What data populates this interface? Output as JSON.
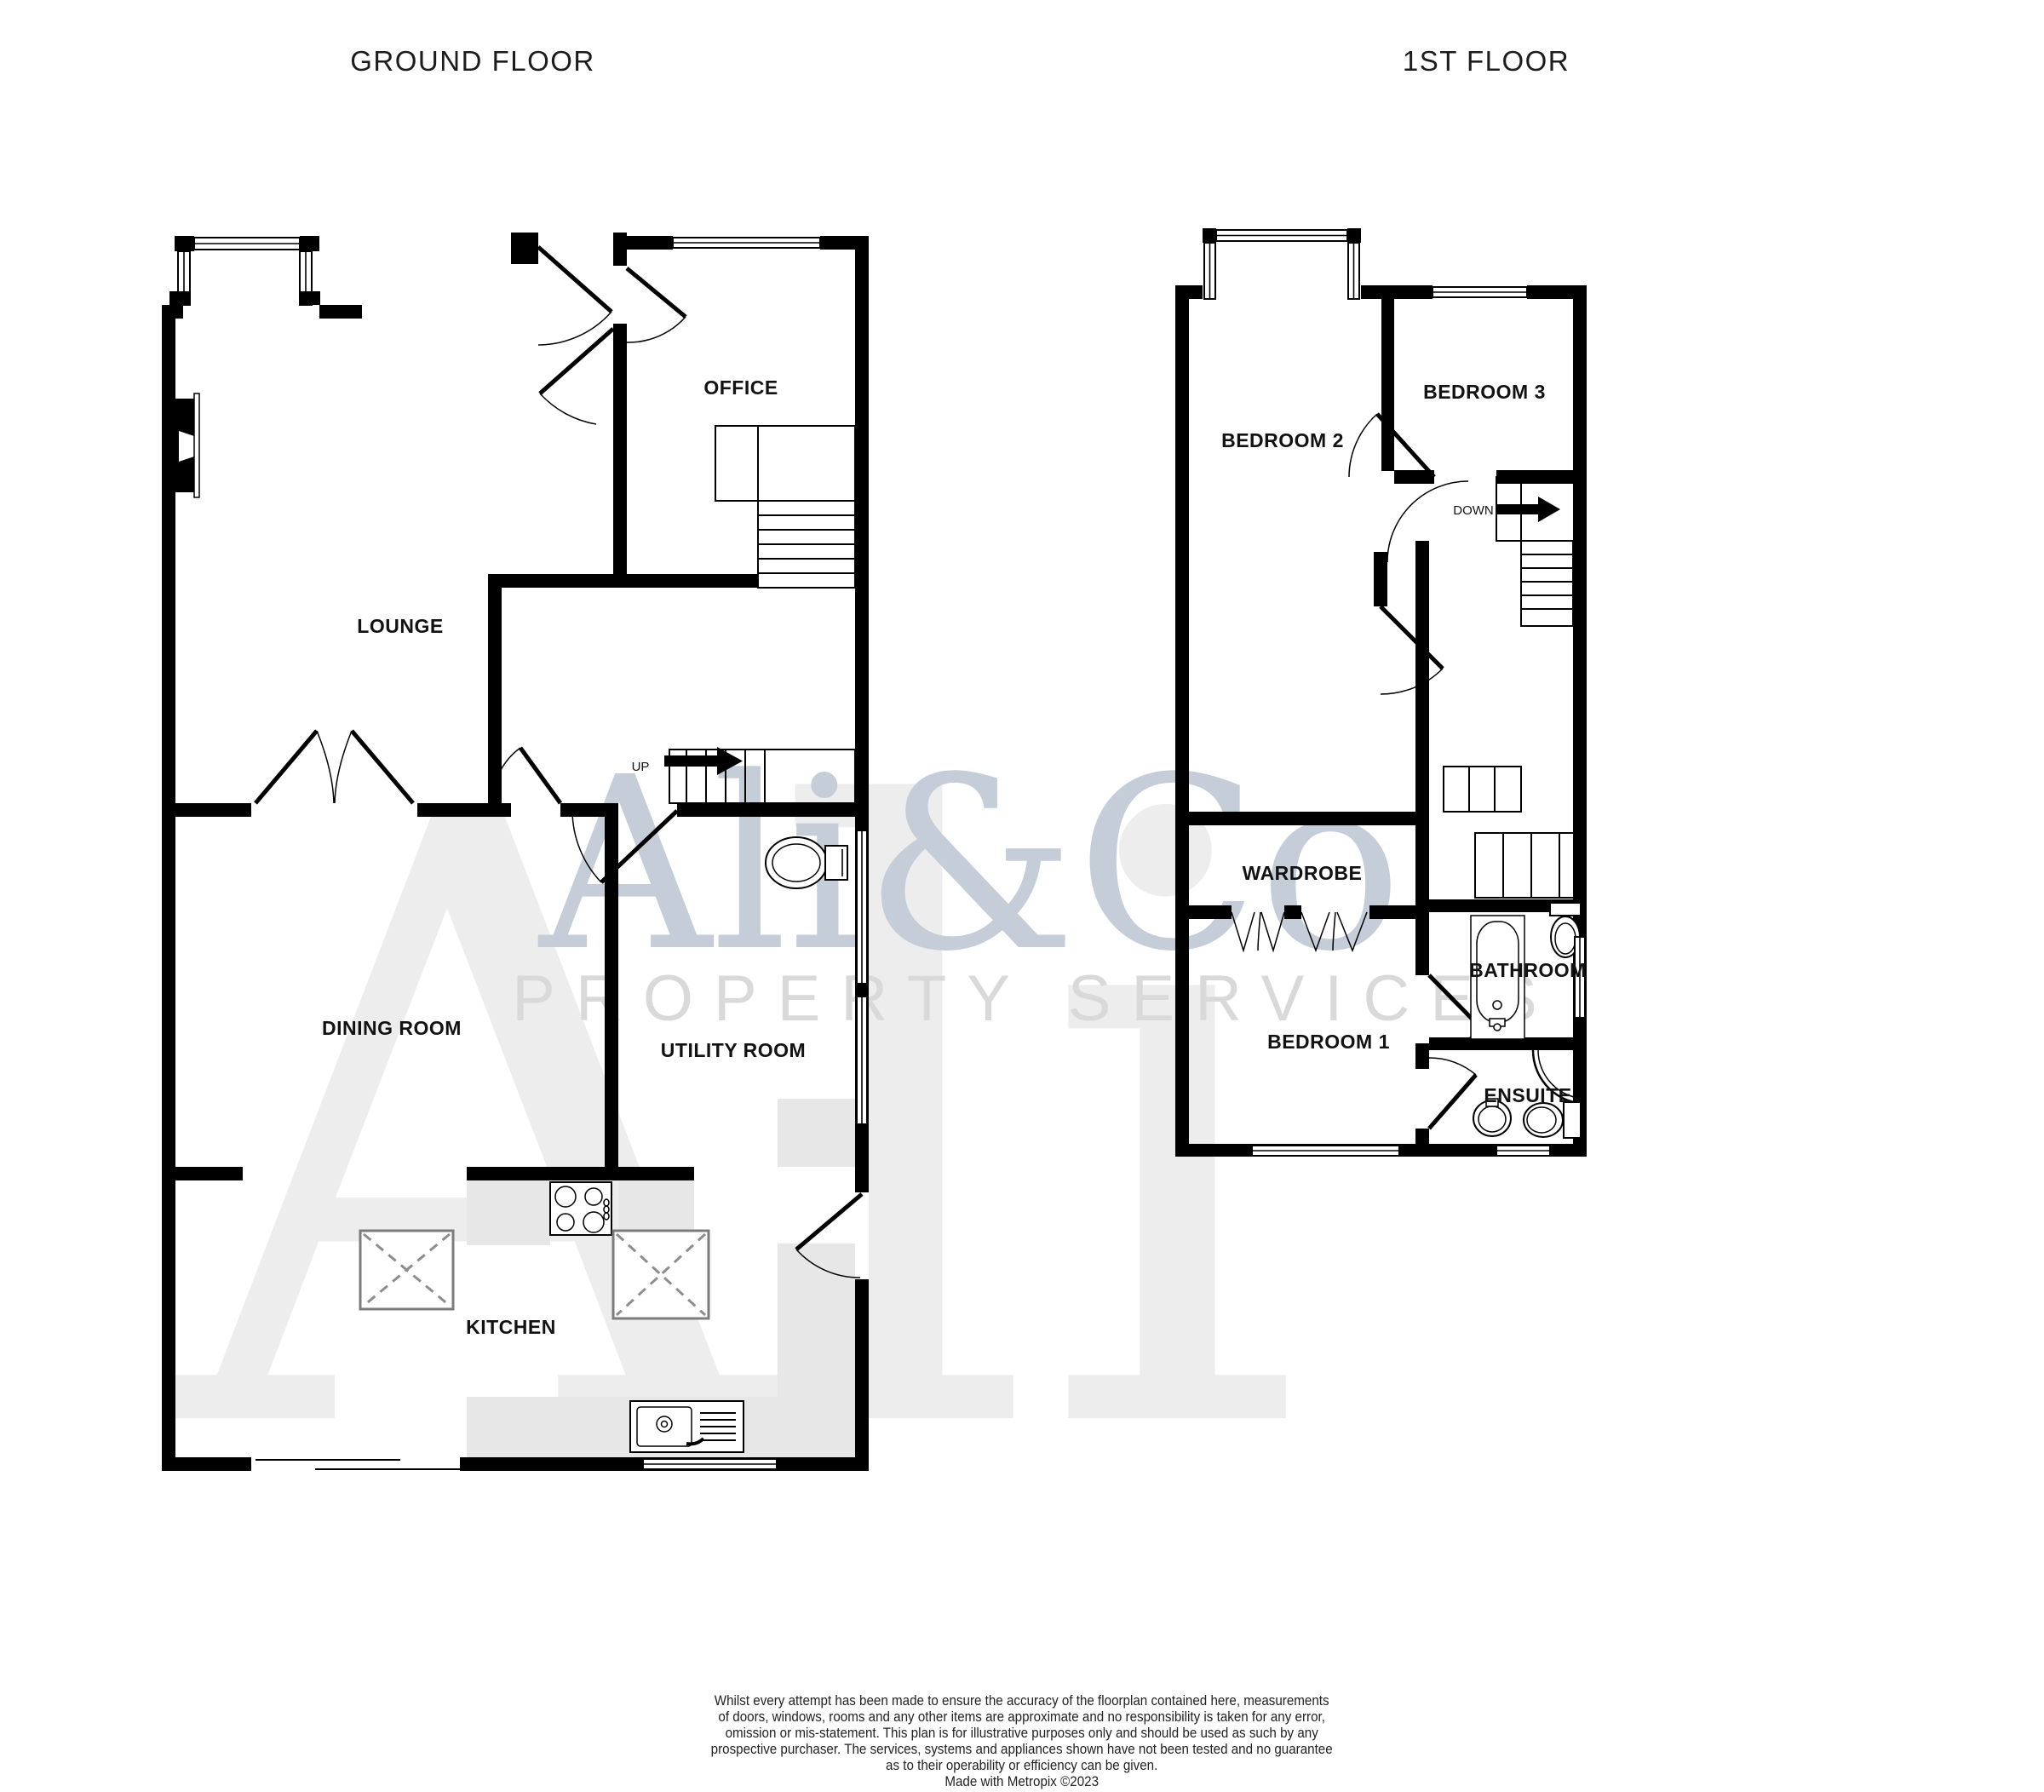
{
  "titles": {
    "ground_floor": "GROUND FLOOR",
    "first_floor": "1ST FLOOR"
  },
  "ground_floor": {
    "rooms": {
      "office": "OFFICE",
      "lounge": "LOUNGE",
      "dining_room": "DINING ROOM",
      "utility_room": "UTILITY ROOM",
      "kitchen": "KITCHEN"
    },
    "stairs_label": "UP"
  },
  "first_floor": {
    "rooms": {
      "bedroom_2": "BEDROOM 2",
      "bedroom_3": "BEDROOM 3",
      "wardrobe": "WARDROBE",
      "bedroom_1": "BEDROOM 1",
      "bathroom": "BATHROOM",
      "ensuite": "ENSUITE"
    },
    "stairs_label": "DOWN"
  },
  "watermark": {
    "ghost_text": "Ali",
    "brand": "Ali&Co",
    "subtitle": "PROPERTY SERVICES",
    "ghost_color": "#ededed",
    "brand_color": "#c5cdd9",
    "subtitle_color": "#d9d9d9"
  },
  "disclaimer": {
    "lines": [
      "Whilst every attempt has been made to ensure the accuracy of the floorplan contained here, measurements",
      "of doors, windows, rooms and any other items are approximate and no responsibility is taken for any error,",
      "omission or mis-statement. This plan is for illustrative purposes only and should be used as such by any",
      "prospective purchaser. The services, systems and appliances shown have not been tested and no guarantee",
      "as to their operability or efficiency can be given.",
      "Made with Metropix ©2023"
    ]
  },
  "colors": {
    "wall": "#000000",
    "counter": "#e7e7e7",
    "label": "#121212",
    "background": "#ffffff"
  }
}
